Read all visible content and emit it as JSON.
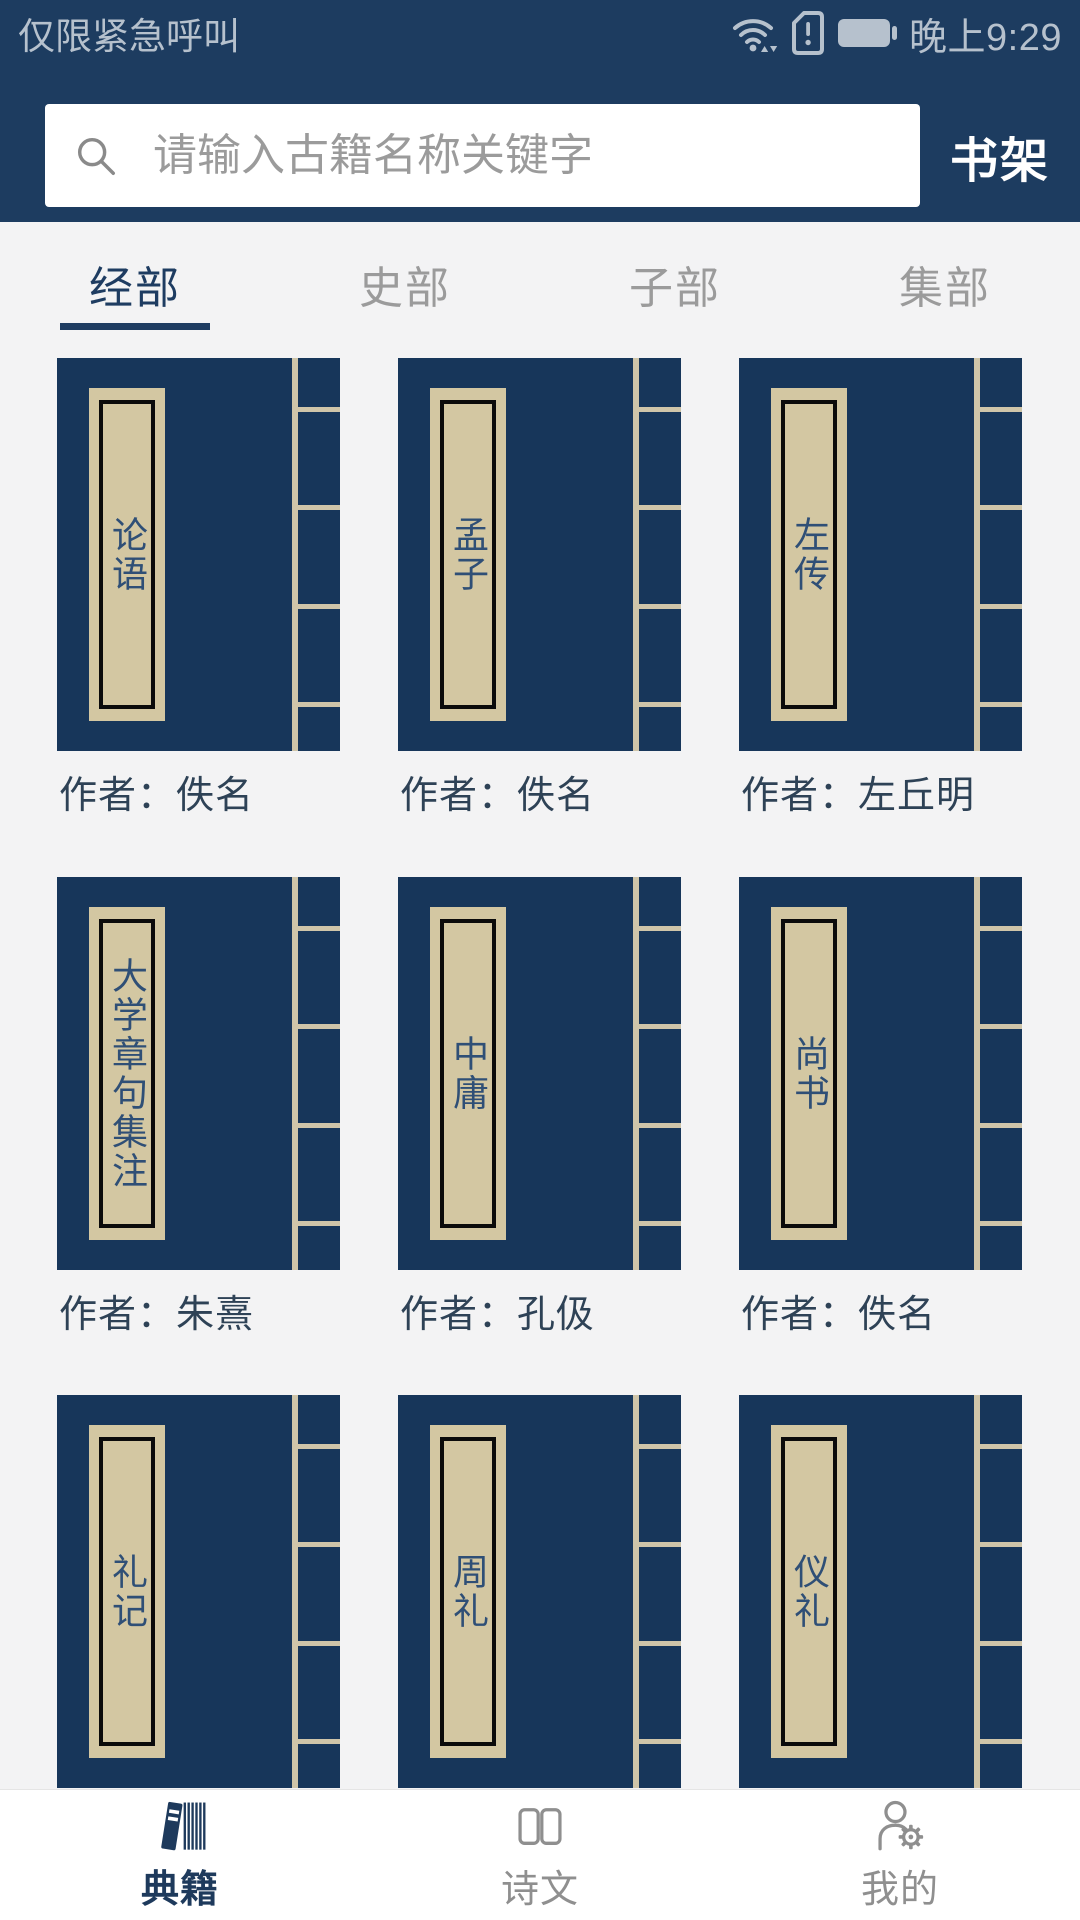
{
  "status_bar": {
    "carrier_text": "仅限紧急呼叫",
    "time": "晚上9:29",
    "icons": [
      "wifi-icon",
      "sim-alert-icon",
      "battery-icon"
    ]
  },
  "search": {
    "placeholder": "请输入古籍名称关键字",
    "value": "",
    "bookshelf_label": "书架"
  },
  "tabs": [
    {
      "label": "经部",
      "active": true
    },
    {
      "label": "史部",
      "active": false
    },
    {
      "label": "子部",
      "active": false
    },
    {
      "label": "集部",
      "active": false
    }
  ],
  "books": [
    {
      "title": "论语",
      "author_line": "作者：佚名"
    },
    {
      "title": "孟子",
      "author_line": "作者：佚名"
    },
    {
      "title": "左传",
      "author_line": "作者：左丘明"
    },
    {
      "title": "大学章句集注",
      "author_line": "作者：朱熹"
    },
    {
      "title": "中庸",
      "author_line": "作者：孔伋"
    },
    {
      "title": "尚书",
      "author_line": "作者：佚名"
    },
    {
      "title": "礼记"
    },
    {
      "title": "周礼"
    },
    {
      "title": "仪礼"
    }
  ],
  "bottom_nav": [
    {
      "label": "典籍",
      "icon": "books-icon",
      "active": true
    },
    {
      "label": "诗文",
      "icon": "open-book-icon",
      "active": false
    },
    {
      "label": "我的",
      "icon": "user-gear-icon",
      "active": false
    }
  ],
  "colors": {
    "header_navy": "#1d3c60",
    "cover_navy": "#17365a",
    "label_beige": "#d3c7a2",
    "binding_beige": "#cfc5a9",
    "tab_active": "#1e3c61",
    "tab_inactive": "#9b9b9b",
    "page_bg": "#f3f3f4",
    "title_text": "#2f4f76",
    "author_text": "#2e4256",
    "nav_active": "#1e3a5c",
    "nav_inactive": "#8f8f8f",
    "status_fg": "#b6c1cd"
  }
}
